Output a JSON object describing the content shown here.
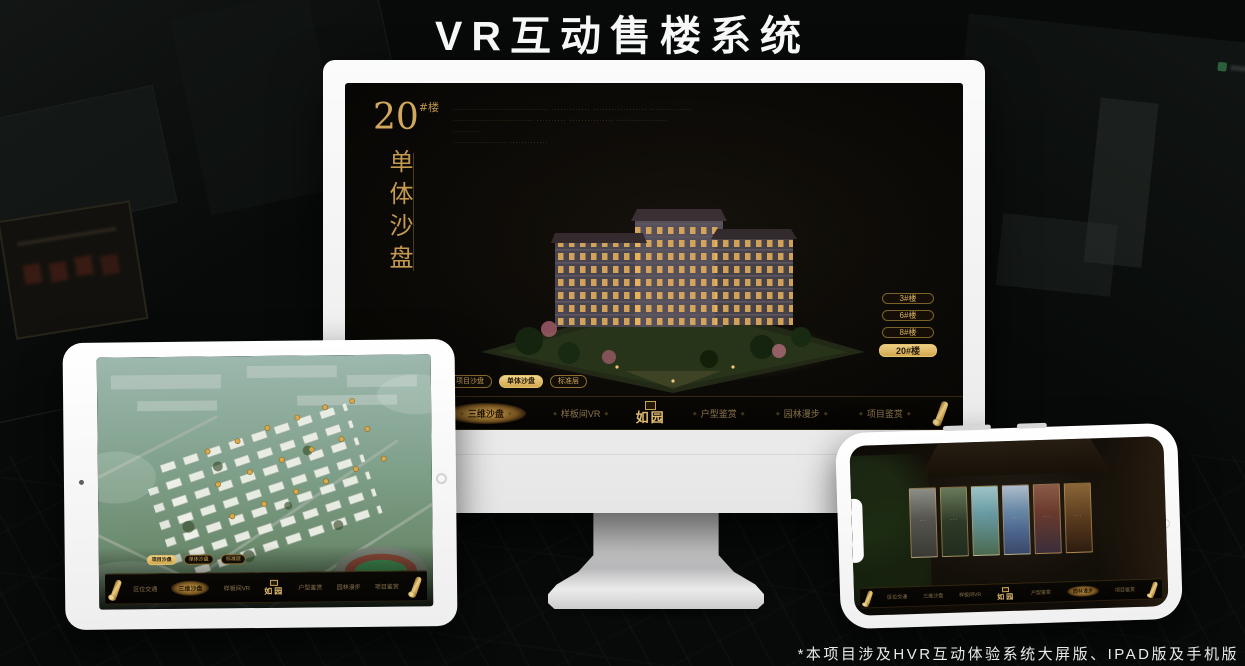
{
  "page": {
    "title": "VR互动售楼系统",
    "footnote": "*本项目涉及HVR互动体验系统大屏版、IPAD版及手机版"
  },
  "colors": {
    "gold": "#cfa45f",
    "gold_bright": "#e6c472",
    "screen_background": "#0c0a07",
    "active_text": "#241a08"
  },
  "monitor_app": {
    "headline": {
      "number": "20",
      "unit": "#楼",
      "vertical_title": "单体沙盘"
    },
    "description_lines": [
      "································  ·············  ··················  ··············",
      "···························  ··········  ···············  ·················",
      "·········",
      "··················  ·············"
    ],
    "floor_buttons": [
      {
        "label": "3#楼",
        "active": false
      },
      {
        "label": "6#楼",
        "active": false
      },
      {
        "label": "8#楼",
        "active": false
      },
      {
        "label": "20#楼",
        "active": true
      }
    ],
    "tabs": [
      {
        "label": "项目沙盘",
        "active": false
      },
      {
        "label": "单体沙盘",
        "active": true
      },
      {
        "label": "标准层",
        "active": false
      }
    ],
    "nav": {
      "logo": "如园",
      "items": [
        {
          "label": "区位交通",
          "active": false
        },
        {
          "label": "三维沙盘",
          "active": true
        },
        {
          "label": "样板间VR",
          "active": false
        },
        {
          "label": "户型鉴赏",
          "active": false
        },
        {
          "label": "园林漫步",
          "active": false
        },
        {
          "label": "项目鉴赏",
          "active": false
        }
      ]
    }
  },
  "tablet_app": {
    "tabs": [
      {
        "label": "项目沙盘",
        "active": true
      },
      {
        "label": "单体沙盘",
        "active": false
      },
      {
        "label": "标准层",
        "active": false
      }
    ],
    "nav": {
      "logo": "如园",
      "items": [
        {
          "label": "区位交通",
          "active": false
        },
        {
          "label": "三维沙盘",
          "active": true
        },
        {
          "label": "样板间VR",
          "active": false
        },
        {
          "label": "户型鉴赏",
          "active": false
        },
        {
          "label": "园林漫步",
          "active": false
        },
        {
          "label": "项目鉴赏",
          "active": false
        }
      ]
    }
  },
  "phone_app": {
    "nav": {
      "logo": "如园",
      "items": [
        {
          "label": "区位交通",
          "active": false
        },
        {
          "label": "三维沙盘",
          "active": false
        },
        {
          "label": "样板间VR",
          "active": false
        },
        {
          "label": "户型鉴赏",
          "active": false
        },
        {
          "label": "园林漫步",
          "active": true
        },
        {
          "label": "项目鉴赏",
          "active": false
        }
      ]
    }
  }
}
